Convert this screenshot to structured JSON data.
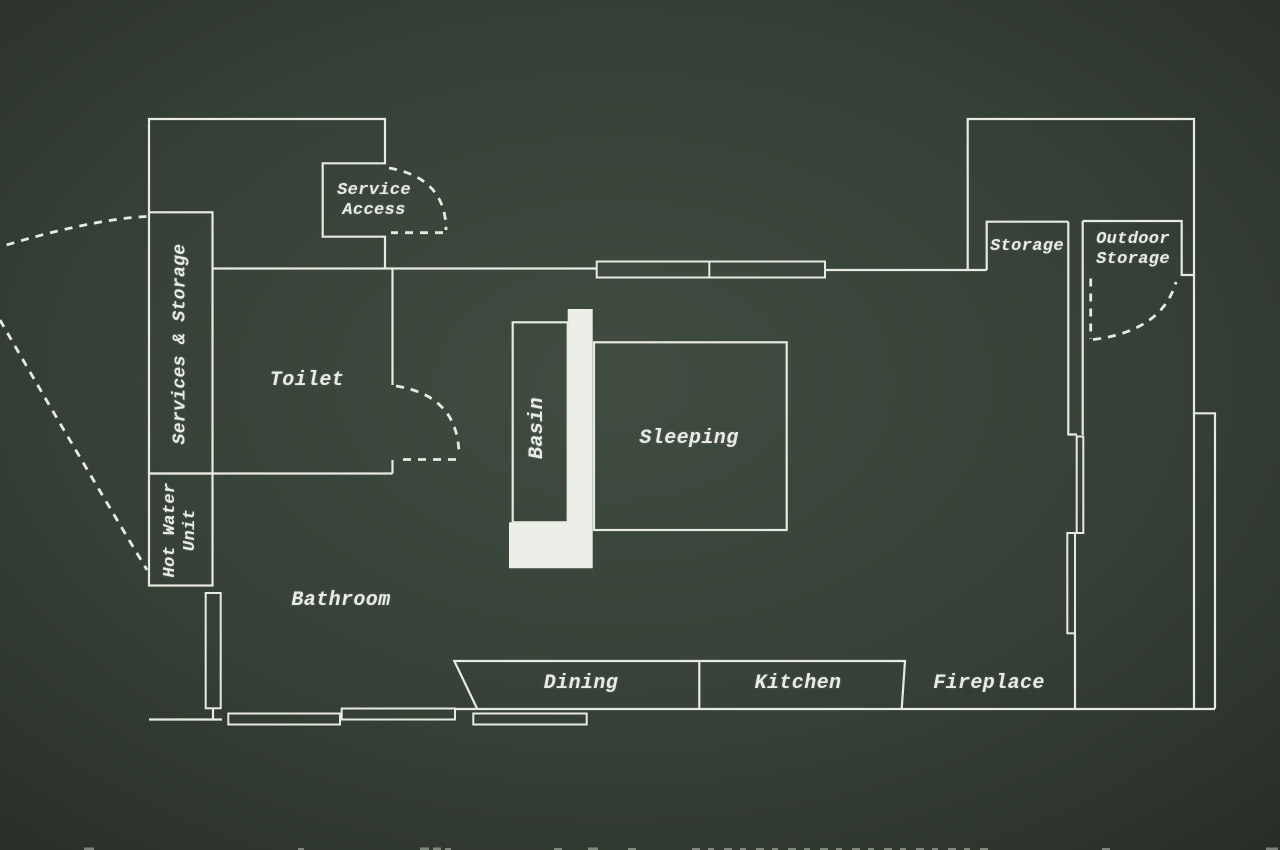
{
  "plan": {
    "type": "architectural-floor-plan",
    "style": "white chalk lines on dark green board",
    "labels": [
      {
        "id": "service-access",
        "lines": [
          "Service",
          "Access"
        ],
        "x": 374,
        "y": 201,
        "size": 17,
        "rotate": 0
      },
      {
        "id": "services-storage",
        "lines": [
          "Services & Storage"
        ],
        "x": 181,
        "y": 344,
        "size": 18,
        "rotate": -90
      },
      {
        "id": "toilet",
        "lines": [
          "Toilet"
        ],
        "x": 307,
        "y": 381,
        "size": 20,
        "rotate": 0
      },
      {
        "id": "hot-water-unit",
        "lines": [
          "Hot Water",
          "Unit"
        ],
        "x": 181,
        "y": 530,
        "size": 17,
        "rotate": -90
      },
      {
        "id": "bathroom",
        "lines": [
          "Bathroom"
        ],
        "x": 341,
        "y": 601,
        "size": 20,
        "rotate": 0
      },
      {
        "id": "basin",
        "lines": [
          "Basin"
        ],
        "x": 538,
        "y": 428,
        "size": 20,
        "rotate": -90
      },
      {
        "id": "sleeping",
        "lines": [
          "Sleeping"
        ],
        "x": 689,
        "y": 439,
        "size": 20,
        "rotate": 0
      },
      {
        "id": "dining",
        "lines": [
          "Dining"
        ],
        "x": 581,
        "y": 684,
        "size": 20,
        "rotate": 0
      },
      {
        "id": "kitchen",
        "lines": [
          "Kitchen"
        ],
        "x": 798,
        "y": 684,
        "size": 20,
        "rotate": 0
      },
      {
        "id": "fireplace",
        "lines": [
          "Fireplace"
        ],
        "x": 989,
        "y": 684,
        "size": 20,
        "rotate": 0
      },
      {
        "id": "storage",
        "lines": [
          "Storage"
        ],
        "x": 1027,
        "y": 247,
        "size": 17,
        "rotate": 0
      },
      {
        "id": "outdoor-storage",
        "lines": [
          "Outdoor",
          "Storage"
        ],
        "x": 1133,
        "y": 250,
        "size": 17,
        "rotate": 0
      }
    ]
  },
  "colors": {
    "bg_center": "#414c41",
    "bg_mid": "#364036",
    "bg_edge": "#272e27",
    "line": "#e7eae1",
    "fill": "#eceee8",
    "text": "#e9ece4"
  }
}
